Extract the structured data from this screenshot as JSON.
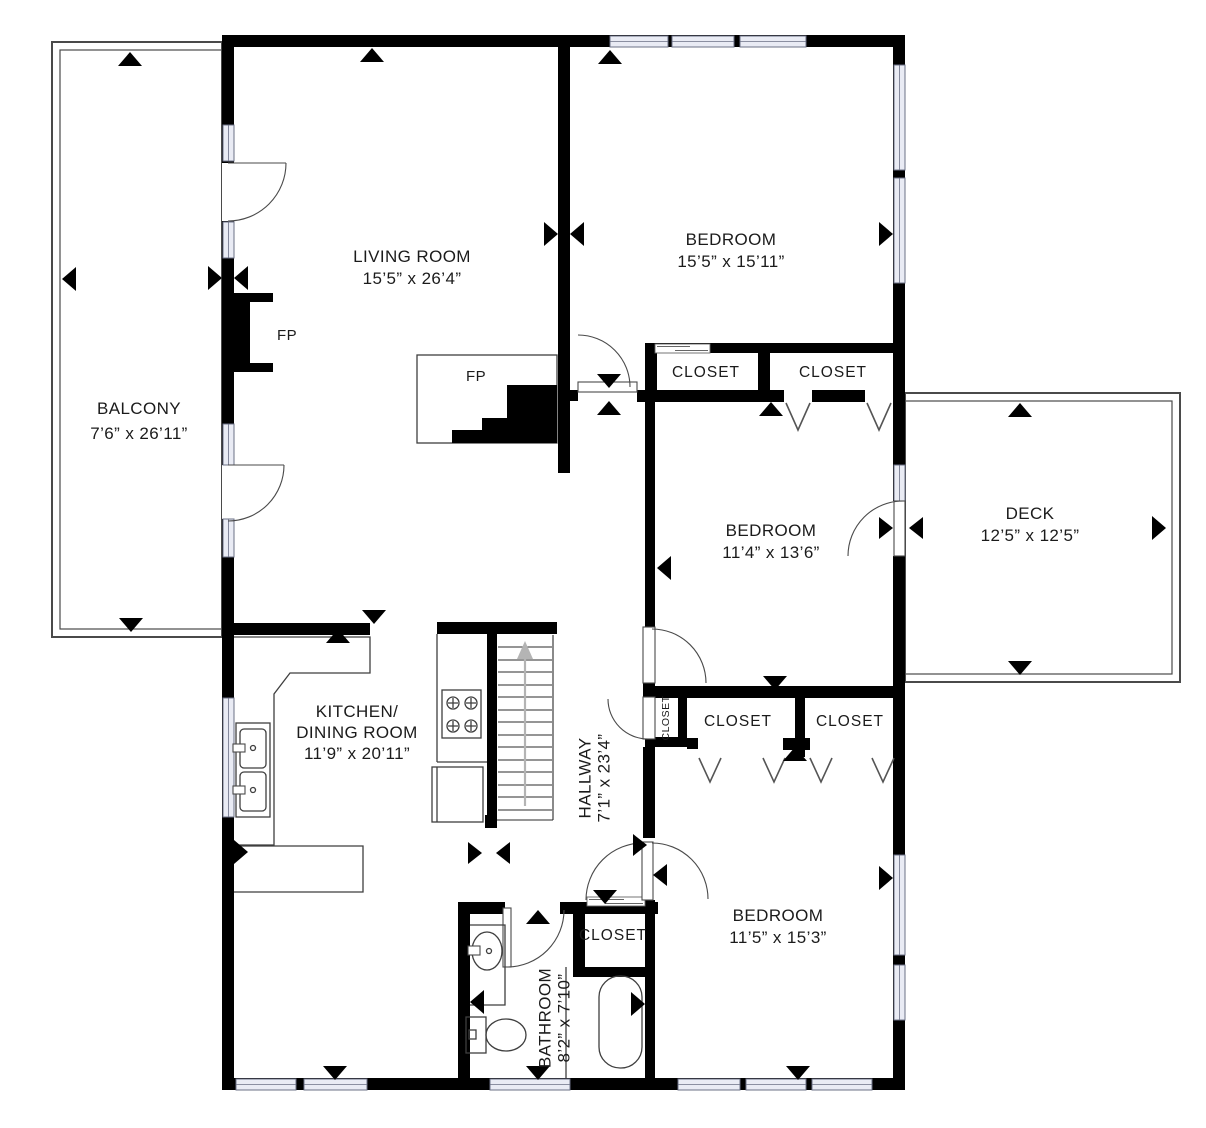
{
  "colors": {
    "wall": "#000000",
    "window_fill": "#e9ebf4",
    "window_stroke": "#6b7086",
    "line": "#3f3f3f",
    "text": "#1b1b1b",
    "background": "#ffffff"
  },
  "rooms": {
    "balcony": {
      "name": "BALCONY",
      "dims": "7’6” x 26’11”"
    },
    "living_room": {
      "name": "LIVING ROOM",
      "dims": "15’5” x 26’4”"
    },
    "bedroom_top": {
      "name": "BEDROOM",
      "dims": "15’5” x 15’11”"
    },
    "bedroom_middle": {
      "name": "BEDROOM",
      "dims": "11’4” x 13’6”"
    },
    "deck": {
      "name": "DECK",
      "dims": "12’5” x 12’5”"
    },
    "kitchen": {
      "name_line1": "KITCHEN/",
      "name_line2": "DINING ROOM",
      "dims": "11’9” x 20’11”"
    },
    "hallway": {
      "name": "HALLWAY",
      "dims": "7’1” x 23’4”"
    },
    "bedroom_bottom": {
      "name": "BEDROOM",
      "dims": "11’5” x 15’3”"
    },
    "bathroom": {
      "name": "BATHROOM",
      "dims": "8’2” x 7’10”"
    }
  },
  "labels": {
    "closet": "CLOSET",
    "fireplace": "FP"
  }
}
